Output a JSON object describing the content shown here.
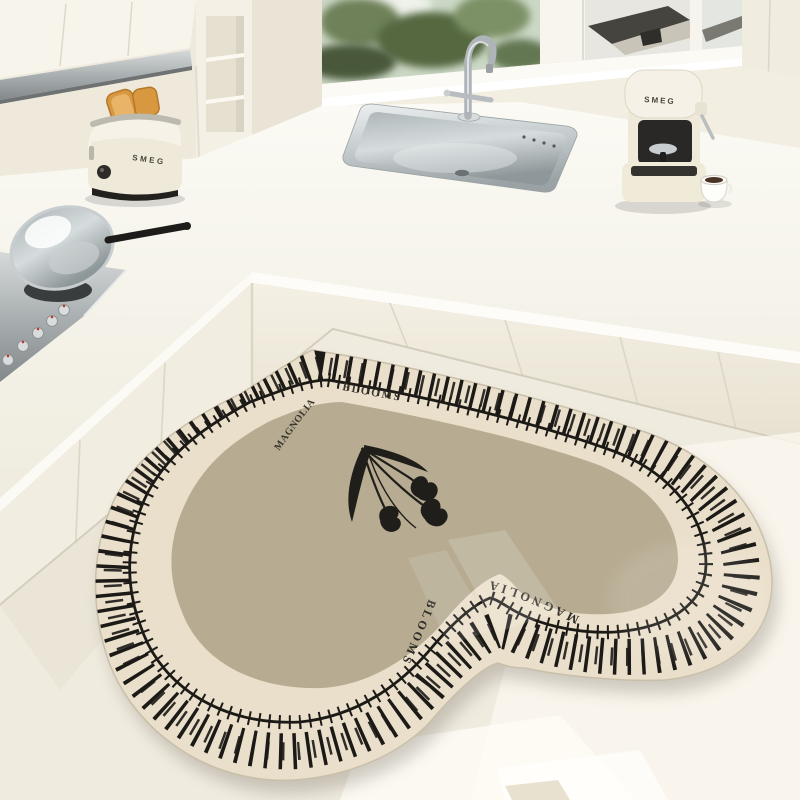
{
  "scene": {
    "title": "cream-kitchen-with-heart-shaped-mat"
  },
  "rug": {
    "word_magnolia": "MAGNOLIA",
    "word_blooms": "BLOOMS",
    "motif": "black-tulips"
  },
  "appliances": {
    "toaster_brand": "SMEG",
    "espresso_brand": "SMEG"
  },
  "palette": {
    "cabinet_cream": "#f3efe3",
    "counter_white": "#f8f6ef",
    "floor": "#f0ebdf",
    "rug_border_cream": "#eadfca",
    "rug_field_greige": "#b7ac92",
    "pattern_black": "#1c1a17",
    "stainless": "#aeb4b8",
    "toast_orange": "#d8983f",
    "window_greenery": "#55683f",
    "sunlight": "#fdfbf3"
  }
}
